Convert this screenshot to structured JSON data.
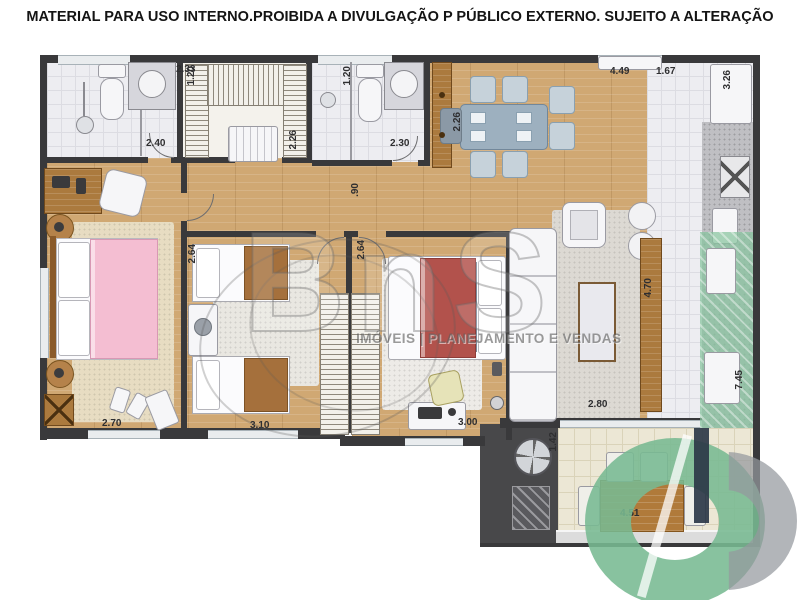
{
  "disclaimer": "MATERIAL PARA USO INTERNO.PROIBIDA A DIVULGAÇÃO P PÚBLICO EXTERNO. SUJEITO A ALTERAÇÃO",
  "watermark": {
    "brand": "BnS",
    "tagline": "IMÓVEIS | PLANEJAMENTO E VENDAS"
  },
  "dimensions": {
    "bath1_width": "2.40",
    "bath1_depth": "1.20",
    "closet_width": "2.33",
    "closet_depth": "2.26",
    "bath2_width": "2.30",
    "bath2_depth": "1.20",
    "entry_panel": "2.26",
    "dining_width": "4.49",
    "kitchen_pass": "1.67",
    "kitchen_depth": "3.26",
    "corridor_width": ".90",
    "bedroom1_width": "2.70",
    "bedroom2_width": "3.10",
    "bedroom2_depth": "2.64",
    "bedroom3_width": "3.00",
    "bedroom3_depth": "2.64",
    "living_width": "2.80",
    "living_depth": "4.70",
    "service_depth": "7.45",
    "balcony_depth": "1.42",
    "balcony_width": "4.51"
  },
  "colors": {
    "wall": "#39393b",
    "wood_floor": "#d0a873",
    "accent_green": "#86c49e",
    "pink_bed": "#f4bed2",
    "red_bed": "#b2524c"
  },
  "icons": [
    "shower-icon",
    "toilet-icon",
    "sink-icon",
    "stove-icon",
    "fridge-icon",
    "grill-icon",
    "dining-table-icon",
    "sofa-icon",
    "bed-icon",
    "lamp-icon",
    "washer-icon"
  ]
}
